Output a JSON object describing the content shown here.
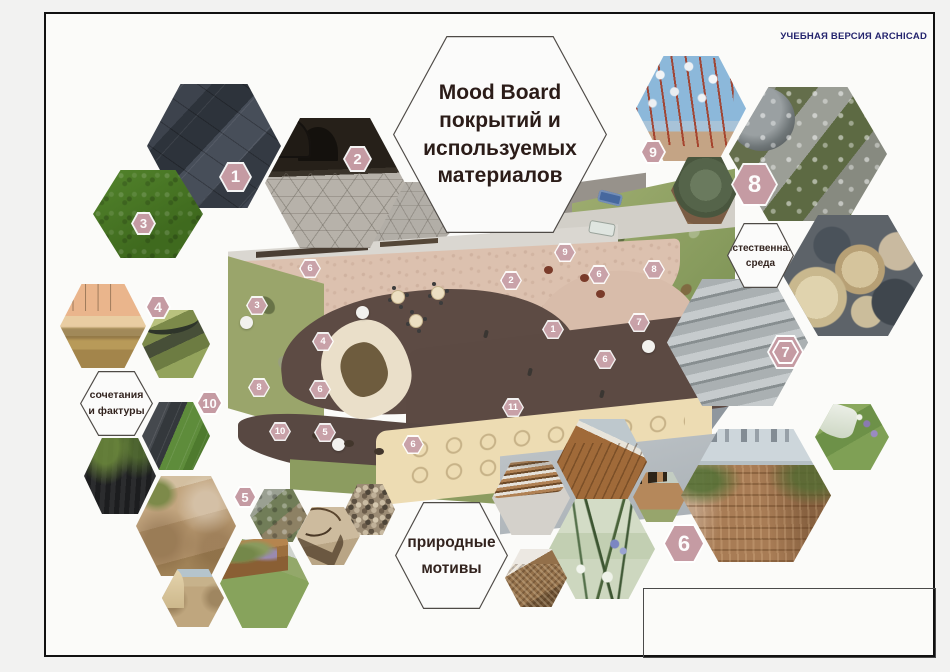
{
  "watermark": "УЧЕБНАЯ ВЕРСИЯ ARCHICAD",
  "title_hex": {
    "line1": "Mood Board",
    "line2": "покрытий и",
    "line3": "используемых",
    "line4": "материалов"
  },
  "label_hexes": {
    "combinations": {
      "line1": "сочетания",
      "line2": "и фактуры"
    },
    "natural_environment": {
      "line1": "естественная",
      "line2": "среда"
    },
    "natural_motifs": {
      "line1": "природные",
      "line2": "мотивы"
    }
  },
  "tile_badges": {
    "slate": "1",
    "patio": "2",
    "lawn": "3",
    "field": "4",
    "desert": "5",
    "terrace": "6",
    "steps": "7",
    "boulders": "8",
    "branches": "9",
    "textures": "10"
  },
  "plan_markers": [
    {
      "n": "6",
      "x": 310,
      "y": 268
    },
    {
      "n": "3",
      "x": 257,
      "y": 305
    },
    {
      "n": "2",
      "x": 511,
      "y": 280
    },
    {
      "n": "9",
      "x": 565,
      "y": 252
    },
    {
      "n": "8",
      "x": 654,
      "y": 269
    },
    {
      "n": "6",
      "x": 599,
      "y": 274
    },
    {
      "n": "1",
      "x": 553,
      "y": 329
    },
    {
      "n": "4",
      "x": 323,
      "y": 341
    },
    {
      "n": "7",
      "x": 639,
      "y": 322
    },
    {
      "n": "6",
      "x": 605,
      "y": 359
    },
    {
      "n": "6",
      "x": 320,
      "y": 389
    },
    {
      "n": "8",
      "x": 259,
      "y": 387
    },
    {
      "n": "10",
      "x": 280,
      "y": 431
    },
    {
      "n": "5",
      "x": 325,
      "y": 432
    },
    {
      "n": "11",
      "x": 513,
      "y": 407
    },
    {
      "n": "6",
      "x": 413,
      "y": 444
    }
  ],
  "colors": {
    "badge_rose": "#c59ba3",
    "frame_black": "#111111",
    "watermark_navy": "#24246e"
  }
}
